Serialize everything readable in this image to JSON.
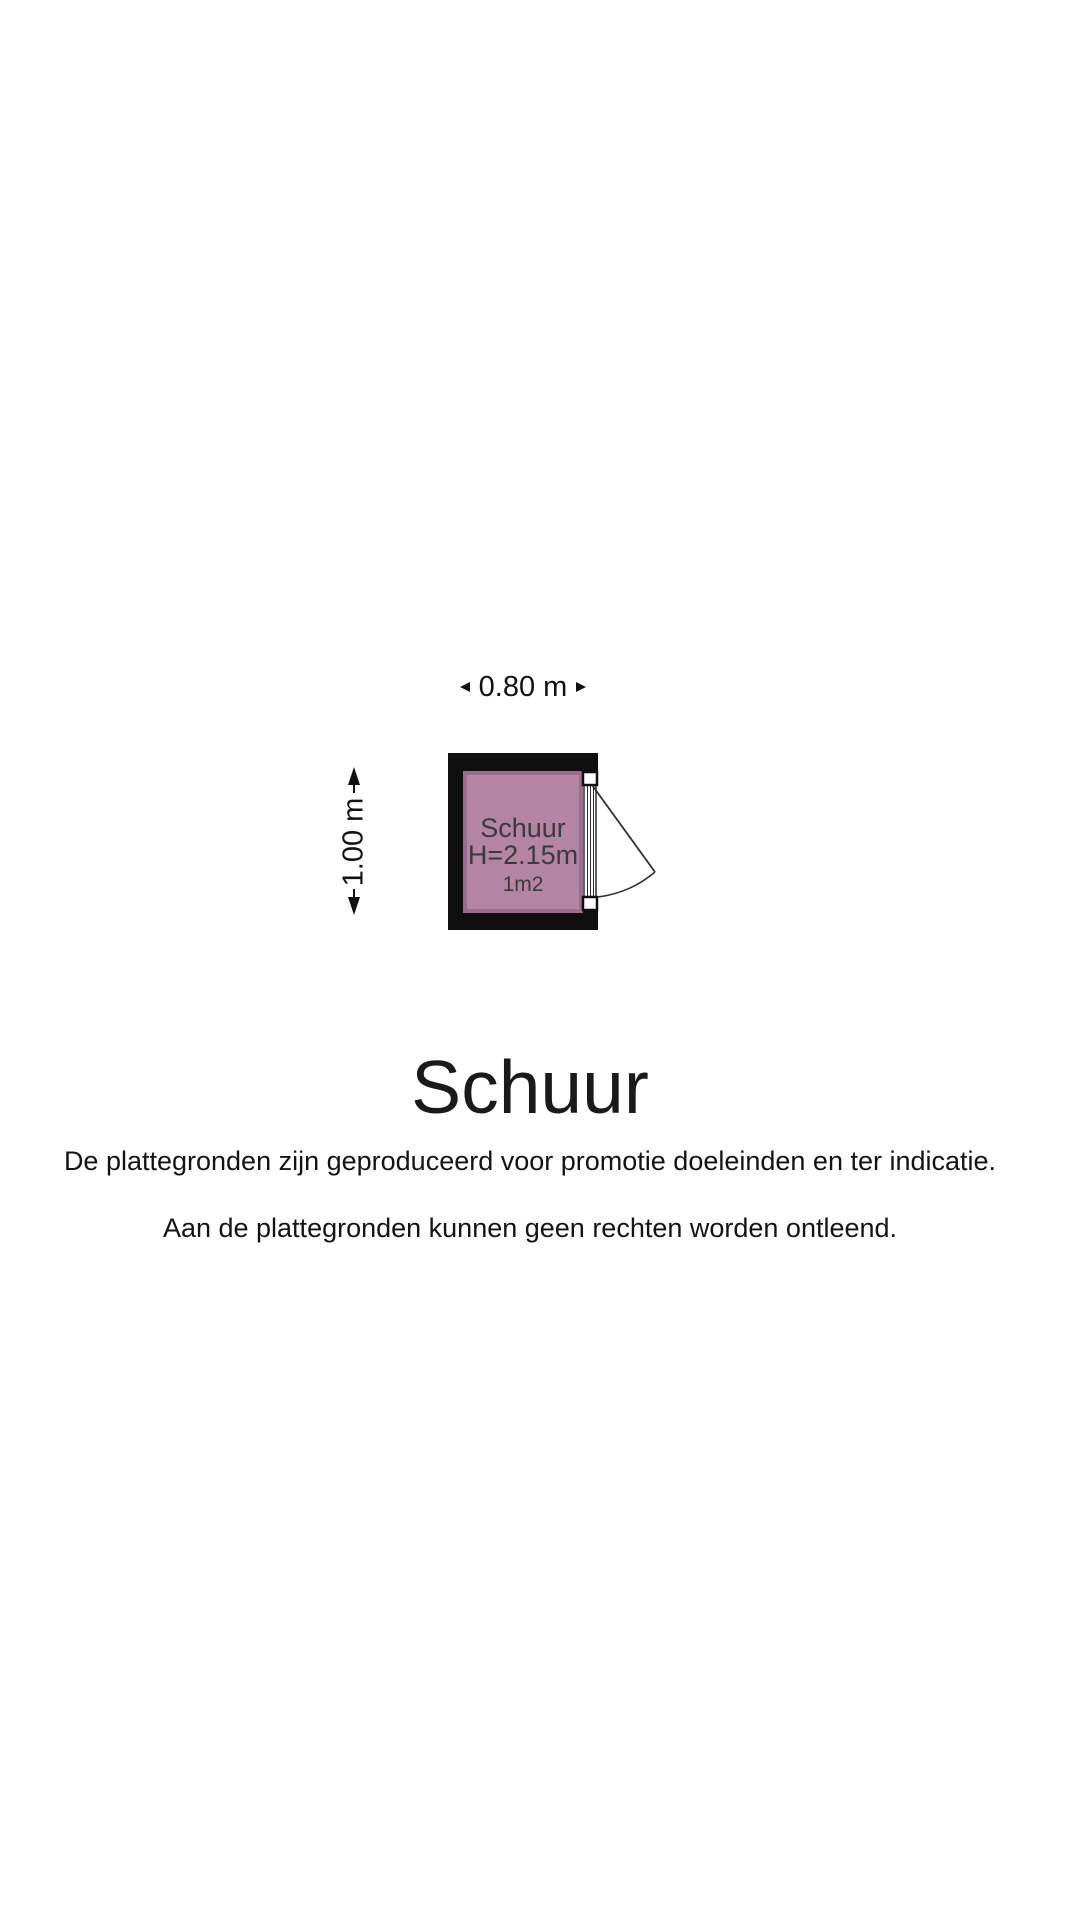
{
  "page": {
    "background": "#ffffff"
  },
  "floorplan": {
    "dimension_width": "0.80 m",
    "dimension_height": "1.00 m",
    "room": {
      "name": "Schuur",
      "ceiling_height": "H=2.15m",
      "area": "1m2"
    },
    "colors": {
      "wall": "#0f0f0f",
      "room_fill": "#b484a3",
      "room_edge": "#9a6c8f",
      "room_text": "#3b3b3b",
      "door_line": "#2e2e2e",
      "door_fill": "#ffffff"
    }
  },
  "footer": {
    "title": "Schuur",
    "disclaimer_line1": "De plattegronden zijn geproduceerd voor promotie doeleinden en ter indicatie.",
    "disclaimer_line2": "Aan de plattegronden kunnen geen rechten worden ontleend."
  }
}
